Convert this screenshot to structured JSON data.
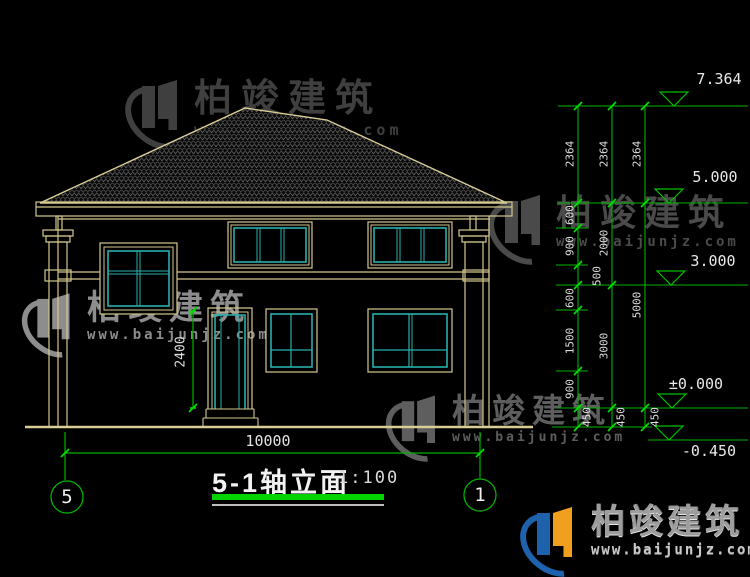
{
  "title": {
    "name": "5-1轴立面",
    "scale": "1:100"
  },
  "axis_bubbles": {
    "left": "5",
    "right": "1"
  },
  "dimensions": {
    "overall_width": "10000",
    "door_height": "2400",
    "chain_inner": [
      "2364",
      "600",
      "900",
      "500",
      "600",
      "1500",
      "900",
      "450"
    ],
    "chain_middle": [
      "2364",
      "2000",
      "3000",
      "450"
    ],
    "chain_outer": [
      "2364",
      "5000",
      "450"
    ]
  },
  "elevation_markers": [
    "7.364",
    "5.000",
    "3.000",
    "±0.000",
    "-0.450"
  ],
  "watermark": {
    "brand": "柏竣建筑",
    "url": "www.baijunjz.com"
  },
  "colors": {
    "background": "#000000",
    "building_line": "#d2c78e",
    "window_sash": "#27b0ac",
    "dimension_green": "#00b400",
    "tick_green": "#00e000",
    "text_white": "#e6e6e6",
    "logo_blue": "#1e62ae",
    "logo_orange": "#f0a01e"
  }
}
